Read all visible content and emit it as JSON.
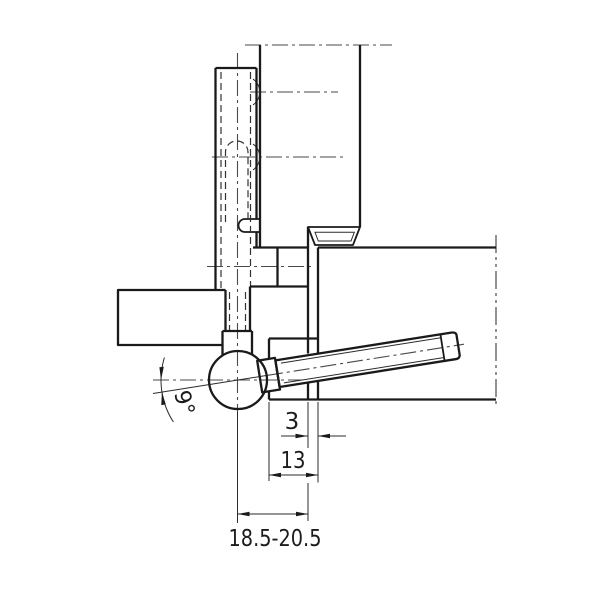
{
  "drawing": {
    "background": "#ffffff",
    "line_color": "#1a1a1a",
    "labels": {
      "angle": "9°",
      "gap": "3",
      "rebate_depth": "13",
      "axis_range": "18.5-20.5"
    }
  }
}
